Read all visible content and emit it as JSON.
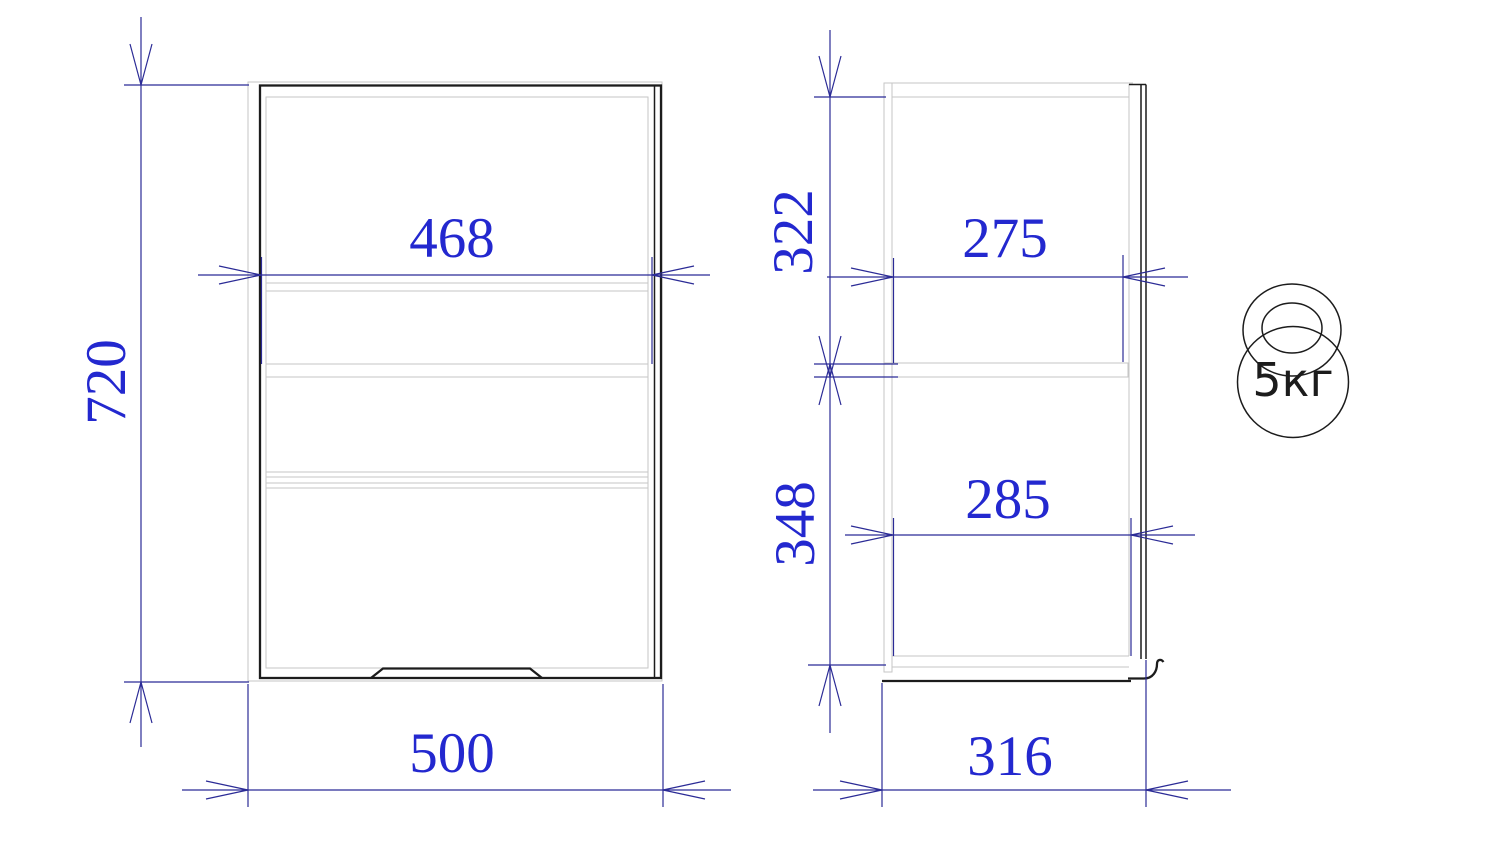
{
  "colors": {
    "background": "#ffffff",
    "dim_line": "#2b2b96",
    "dim_text": "#2328cf",
    "body_line": "#1c1c1c",
    "panel_line": "#c6c6c6"
  },
  "dimensions": {
    "front_overall_height": "720",
    "front_inner_width": "468",
    "front_overall_width": "500",
    "side_upper_section_height": "322",
    "side_lower_section_height": "348",
    "side_upper_inner_depth": "275",
    "side_lower_inner_depth": "285",
    "side_overall_depth": "316"
  },
  "weight_capacity": {
    "label": "5кг"
  }
}
